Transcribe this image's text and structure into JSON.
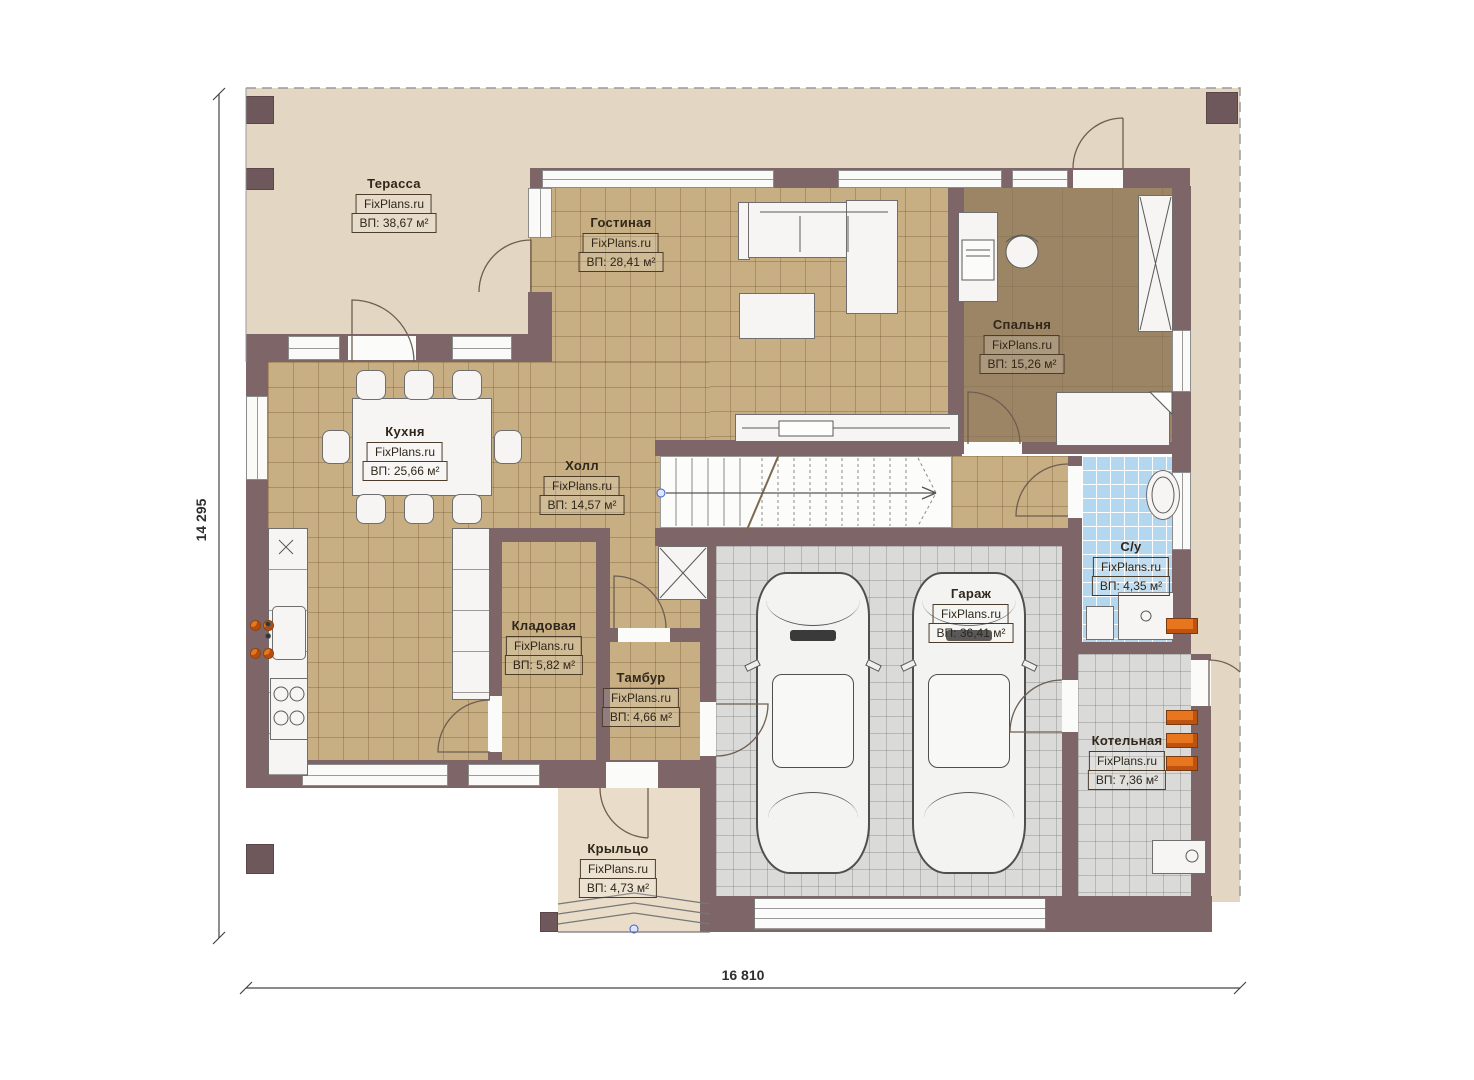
{
  "brand": "FixPlans.ru",
  "rooms": [
    {
      "id": "terrace",
      "name": "Терасса",
      "area": "ВП: 38,67 м²"
    },
    {
      "id": "living",
      "name": "Гостиная",
      "area": "ВП: 28,41 м²"
    },
    {
      "id": "bedroom",
      "name": "Спальня",
      "area": "ВП: 15,26 м²"
    },
    {
      "id": "kitchen",
      "name": "Кухня",
      "area": "ВП: 25,66 м²"
    },
    {
      "id": "hall",
      "name": "Холл",
      "area": "ВП: 14,57 м²"
    },
    {
      "id": "bathroom",
      "name": "С/у",
      "area": "ВП: 4,35 м²"
    },
    {
      "id": "storage",
      "name": "Кладовая",
      "area": "ВП: 5,82 м²"
    },
    {
      "id": "vestibule",
      "name": "Тамбур",
      "area": "ВП: 4,66 м²"
    },
    {
      "id": "garage",
      "name": "Гараж",
      "area": "ВП: 36,41 м²"
    },
    {
      "id": "boiler",
      "name": "Котельная",
      "area": "ВП: 7,36 м²"
    },
    {
      "id": "porch",
      "name": "Крыльцо",
      "area": "ВП: 4,73 м²"
    }
  ],
  "dimensions": {
    "height_label": "14 295",
    "width_label": "16 810"
  },
  "colors": {
    "wall": "#7d6568",
    "tile_tan": "#c7ae83",
    "bedroom_floor": "#9c8565",
    "garage_floor": "#dadad8",
    "bath_tile": "#b4d7f0",
    "site_cream": "#e3d6c2",
    "equipment_orange": "#e8761e"
  }
}
